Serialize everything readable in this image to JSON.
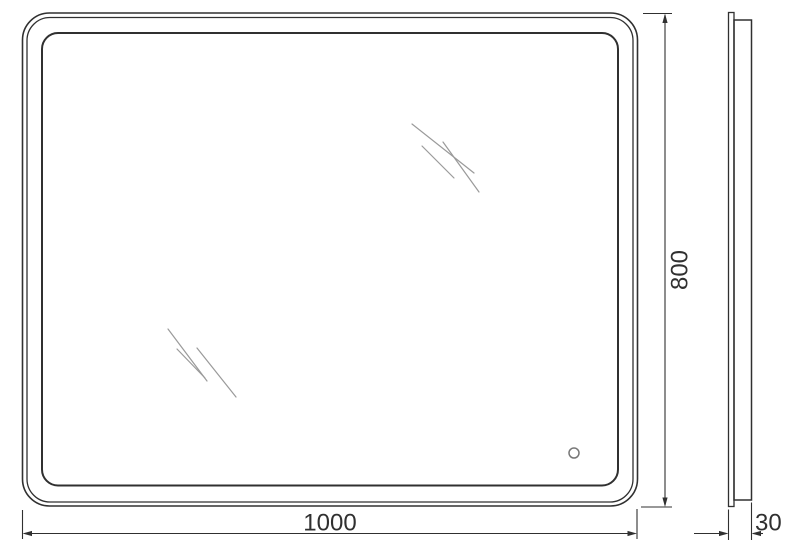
{
  "drawing": {
    "type": "mirror-technical-drawing",
    "views": {
      "front": "mirror-front-view",
      "side": "mirror-side-profile-view"
    }
  },
  "dimensions": {
    "width": "1000",
    "height": "800",
    "depth": "30"
  },
  "icons": {
    "touch_sensor": "touch-sensor-circle-icon",
    "glass_shine": "glass-shine-icon"
  },
  "colors": {
    "line": "#303030",
    "shine": "#9a9a9a",
    "sensor": "#787878",
    "background": "#ffffff"
  }
}
